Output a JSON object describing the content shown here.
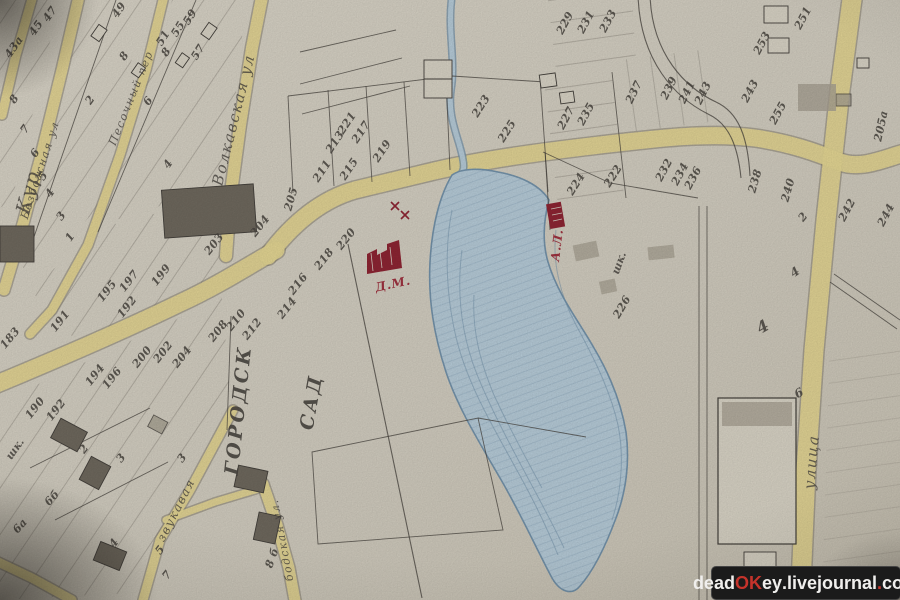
{
  "colors": {
    "paper": "#d5d0c3",
    "paper2": "#d9d4c6",
    "ink": "#44403b",
    "pencil": "#a7a092",
    "bdark": "#6f695e",
    "road": "#e5d795",
    "roadedge": "#86806f",
    "pond": "#b7ccd9",
    "pondline": "#7493ab",
    "red": "#8e2533",
    "wm_bg": "#1b1b1b",
    "wm_fg": "#f0efed",
    "wm_red": "#c5332b"
  },
  "watermark": {
    "p1": "dead",
    "p2": "OK",
    "p3": "ey",
    "d1": ".",
    "p4": "livejournal",
    "d2": ".",
    "p5": "com"
  },
  "map": {
    "street_names": [
      "Волкавская ул",
      "Безбожная ул",
      "Песочный пер",
      "Кур",
      "улица",
      "звукавая",
      "бодская ул."
    ],
    "landmarks": [
      "ГОРОДСК САД",
      "шк.",
      "Д.М.",
      "А.Л."
    ],
    "labels": [
      {
        "t": "47",
        "x": 50,
        "y": 14,
        "r": -55
      },
      {
        "t": "45",
        "x": 36,
        "y": 28,
        "r": -55
      },
      {
        "t": "43а",
        "x": 14,
        "y": 47,
        "r": -55
      },
      {
        "t": "49",
        "x": 119,
        "y": 10,
        "r": -55
      },
      {
        "t": "59",
        "x": 190,
        "y": 17,
        "r": -58
      },
      {
        "t": "55",
        "x": 178,
        "y": 29,
        "r": -58
      },
      {
        "t": "51",
        "x": 163,
        "y": 38,
        "r": -58
      },
      {
        "t": "57",
        "x": 198,
        "y": 52,
        "r": -58
      },
      {
        "t": "8",
        "x": 166,
        "y": 52,
        "r": -55
      },
      {
        "t": "8",
        "x": 124,
        "y": 56,
        "r": -55
      },
      {
        "t": "6",
        "x": 148,
        "y": 101,
        "r": -55
      },
      {
        "t": "4",
        "x": 168,
        "y": 164,
        "r": -55
      },
      {
        "t": "2",
        "x": 90,
        "y": 100,
        "r": -55
      },
      {
        "t": "8",
        "x": 14,
        "y": 99,
        "r": -55
      },
      {
        "t": "7",
        "x": 25,
        "y": 129,
        "r": -55
      },
      {
        "t": "6",
        "x": 35,
        "y": 153,
        "r": -55
      },
      {
        "t": "5",
        "x": 43,
        "y": 176,
        "r": -55
      },
      {
        "t": "4",
        "x": 50,
        "y": 193,
        "r": -55
      },
      {
        "t": "3",
        "x": 61,
        "y": 216,
        "r": -55
      },
      {
        "t": "1",
        "x": 70,
        "y": 237,
        "r": -55
      },
      {
        "t": "183",
        "x": 10,
        "y": 338,
        "r": -50
      },
      {
        "t": "191",
        "x": 60,
        "y": 321,
        "r": -52
      },
      {
        "t": "195",
        "x": 107,
        "y": 291,
        "r": -52
      },
      {
        "t": "197",
        "x": 129,
        "y": 281,
        "r": -52
      },
      {
        "t": "199",
        "x": 161,
        "y": 275,
        "r": -52
      },
      {
        "t": "192",
        "x": 127,
        "y": 307,
        "r": -52
      },
      {
        "t": "203",
        "x": 214,
        "y": 244,
        "r": -52
      },
      {
        "t": "204",
        "x": 260,
        "y": 226,
        "r": -52
      },
      {
        "t": "205",
        "x": 291,
        "y": 199,
        "r": -74
      },
      {
        "t": "194",
        "x": 95,
        "y": 375,
        "r": -52
      },
      {
        "t": "196",
        "x": 112,
        "y": 378,
        "r": -52
      },
      {
        "t": "200",
        "x": 142,
        "y": 357,
        "r": -52
      },
      {
        "t": "202",
        "x": 163,
        "y": 352,
        "r": -52
      },
      {
        "t": "204",
        "x": 182,
        "y": 357,
        "r": -52
      },
      {
        "t": "208",
        "x": 218,
        "y": 331,
        "r": -52
      },
      {
        "t": "210",
        "x": 236,
        "y": 320,
        "r": -52
      },
      {
        "t": "212",
        "x": 252,
        "y": 329,
        "r": -52
      },
      {
        "t": "214",
        "x": 287,
        "y": 308,
        "r": -52
      },
      {
        "t": "216",
        "x": 298,
        "y": 284,
        "r": -52
      },
      {
        "t": "218",
        "x": 324,
        "y": 259,
        "r": -52
      },
      {
        "t": "220",
        "x": 346,
        "y": 239,
        "r": -52
      },
      {
        "t": "190",
        "x": 35,
        "y": 408,
        "r": -52
      },
      {
        "t": "192",
        "x": 56,
        "y": 410,
        "r": -52
      },
      {
        "t": "2",
        "x": 84,
        "y": 449,
        "r": -52
      },
      {
        "t": "3",
        "x": 121,
        "y": 458,
        "r": -52
      },
      {
        "t": "3",
        "x": 182,
        "y": 458,
        "r": -52
      },
      {
        "t": "6б",
        "x": 52,
        "y": 498,
        "r": -48
      },
      {
        "t": "6а",
        "x": 20,
        "y": 526,
        "r": -48
      },
      {
        "t": "4",
        "x": 114,
        "y": 543,
        "r": -52
      },
      {
        "t": "5",
        "x": 160,
        "y": 550,
        "r": -52
      },
      {
        "t": "7",
        "x": 167,
        "y": 575,
        "r": -52
      },
      {
        "t": "8 б",
        "x": 272,
        "y": 558,
        "r": -70
      },
      {
        "t": "211",
        "x": 322,
        "y": 171,
        "r": -56
      },
      {
        "t": "213",
        "x": 335,
        "y": 142,
        "r": -56
      },
      {
        "t": "215",
        "x": 349,
        "y": 169,
        "r": -56
      },
      {
        "t": "217",
        "x": 361,
        "y": 132,
        "r": -56
      },
      {
        "t": "219",
        "x": 382,
        "y": 151,
        "r": -56
      },
      {
        "t": "221",
        "x": 347,
        "y": 123,
        "r": -56
      },
      {
        "t": "223",
        "x": 481,
        "y": 106,
        "r": -58
      },
      {
        "t": "225",
        "x": 507,
        "y": 131,
        "r": -58
      },
      {
        "t": "227",
        "x": 566,
        "y": 118,
        "r": -62
      },
      {
        "t": "235",
        "x": 586,
        "y": 114,
        "r": -62
      },
      {
        "t": "229",
        "x": 565,
        "y": 23,
        "r": -62
      },
      {
        "t": "231",
        "x": 586,
        "y": 22,
        "r": -62
      },
      {
        "t": "233",
        "x": 608,
        "y": 21,
        "r": -62
      },
      {
        "t": "237",
        "x": 634,
        "y": 92,
        "r": -64
      },
      {
        "t": "239",
        "x": 669,
        "y": 88,
        "r": -64
      },
      {
        "t": "241",
        "x": 687,
        "y": 92,
        "r": -64
      },
      {
        "t": "243",
        "x": 703,
        "y": 93,
        "r": -64
      },
      {
        "t": "243",
        "x": 750,
        "y": 91,
        "r": -62
      },
      {
        "t": "253",
        "x": 762,
        "y": 43,
        "r": -62
      },
      {
        "t": "251",
        "x": 803,
        "y": 18,
        "r": -62
      },
      {
        "t": "255",
        "x": 778,
        "y": 113,
        "r": -62
      },
      {
        "t": "224",
        "x": 576,
        "y": 184,
        "r": -58
      },
      {
        "t": "222",
        "x": 613,
        "y": 176,
        "r": -58
      },
      {
        "t": "232",
        "x": 664,
        "y": 170,
        "r": -62
      },
      {
        "t": "234",
        "x": 680,
        "y": 174,
        "r": -62
      },
      {
        "t": "236",
        "x": 693,
        "y": 178,
        "r": -62
      },
      {
        "t": "226",
        "x": 622,
        "y": 307,
        "r": -60
      },
      {
        "t": "238",
        "x": 755,
        "y": 181,
        "r": -74
      },
      {
        "t": "240",
        "x": 788,
        "y": 190,
        "r": -74
      },
      {
        "t": "2",
        "x": 803,
        "y": 217,
        "r": -50
      },
      {
        "t": "242",
        "x": 847,
        "y": 210,
        "r": -62
      },
      {
        "t": "244",
        "x": 886,
        "y": 215,
        "r": -62
      },
      {
        "t": "205а",
        "x": 881,
        "y": 126,
        "r": -78
      },
      {
        "t": "4",
        "x": 763,
        "y": 327,
        "r": -30,
        "s": 16
      },
      {
        "t": "4",
        "x": 795,
        "y": 272,
        "r": -35,
        "s": 12
      },
      {
        "t": "6",
        "x": 799,
        "y": 393,
        "r": -30,
        "s": 12
      },
      {
        "t": "шк.",
        "x": 619,
        "y": 263,
        "r": -70,
        "k": "lm"
      },
      {
        "t": "шк.",
        "x": 15,
        "y": 449,
        "r": -55,
        "k": "lm"
      },
      {
        "t": "Волкавская ул",
        "x": 234,
        "y": 120,
        "r": -76,
        "s": 15,
        "k": "st"
      },
      {
        "t": "Безбожная ул",
        "x": 40,
        "y": 170,
        "r": -72,
        "s": 11,
        "k": "st"
      },
      {
        "t": "Песочный пер",
        "x": 131,
        "y": 98,
        "r": -68,
        "s": 11,
        "k": "st"
      },
      {
        "t": "Кур",
        "x": 28,
        "y": 192,
        "r": -75,
        "s": 20,
        "k": "st"
      },
      {
        "t": "улица",
        "x": 812,
        "y": 462,
        "r": -85,
        "s": 15,
        "k": "st"
      },
      {
        "t": "звукавая",
        "x": 176,
        "y": 510,
        "r": -63,
        "s": 12,
        "k": "st"
      },
      {
        "t": "бодская ул.",
        "x": 282,
        "y": 540,
        "r": -101,
        "s": 11,
        "k": "st"
      },
      {
        "t": "ГОРОДСК",
        "x": 239,
        "y": 410,
        "r": -84,
        "s": 19,
        "k": "gd"
      },
      {
        "t": "САД",
        "x": 312,
        "y": 402,
        "r": -80,
        "s": 19,
        "k": "gd"
      },
      {
        "t": "Д.М.",
        "x": 393,
        "y": 284,
        "r": -12,
        "s": 12,
        "k": "rd"
      },
      {
        "t": "А.Л.",
        "x": 557,
        "y": 245,
        "r": -83,
        "s": 12,
        "k": "rd"
      }
    ]
  }
}
